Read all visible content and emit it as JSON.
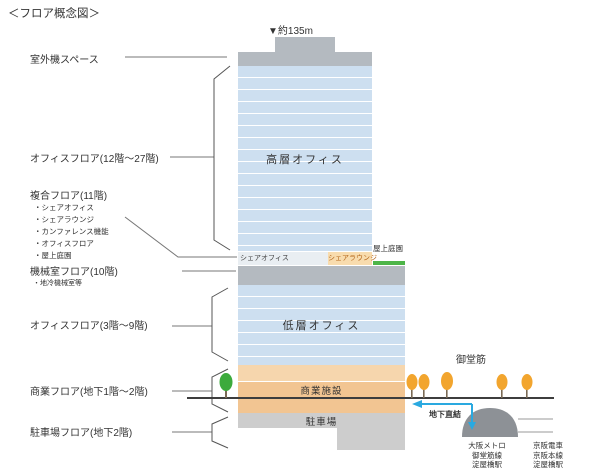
{
  "header": {
    "title": "＜フロア概念図＞"
  },
  "building": {
    "height_marker": "▼約135m",
    "high_office_label": "高層オフィス",
    "share_office_label": "シェアオフィス",
    "share_lounge_label": "シェアラウンジ",
    "roof_garden_label": "屋上庭園",
    "low_office_label": "低層オフィス",
    "commercial_label": "商業施設",
    "parking_label": "駐車場"
  },
  "floor_labels": {
    "outdoor_unit": "室外機スペース",
    "office_high": "オフィスフロア(12階〜27階)",
    "mixed_use": "複合フロア(11階)",
    "mixed_use_items": [
      "・シェアオフィス",
      "・シェアラウンジ",
      "・カンファレンス機能",
      "・オフィスフロア",
      "・屋上庭園"
    ],
    "machine_room": "機械室フロア(10階)",
    "machine_room_item": "・地冷機械室等",
    "office_low": "オフィスフロア(3階〜9階)",
    "commercial": "商業フロア(地下1階〜2階)",
    "parking": "駐車場フロア(地下2階)"
  },
  "street": {
    "name": "御堂筋",
    "underground_link": "地下直結"
  },
  "stations": {
    "metro": {
      "line1": "大阪メトロ",
      "line2": "御堂筋線",
      "line3": "淀屋橋駅"
    },
    "keihan": {
      "line1": "京阪電車",
      "line2": "京阪本線",
      "line3": "淀屋橋駅"
    }
  },
  "colors": {
    "tower_blue": "#cddff0",
    "machine_gray": "#b4bac0",
    "lounge_orange": "#f8dcae",
    "commercial_orange": "#f2c592",
    "commercial_orange_light": "#f6d6ad",
    "parking_gray": "#cdcdcd",
    "roof_garden_green": "#4db548",
    "tree_green": "#3caa3c",
    "tree_orange": "#f2a52e",
    "arrow_blue": "#2aa9e0",
    "dome_gray": "#8d9196"
  }
}
